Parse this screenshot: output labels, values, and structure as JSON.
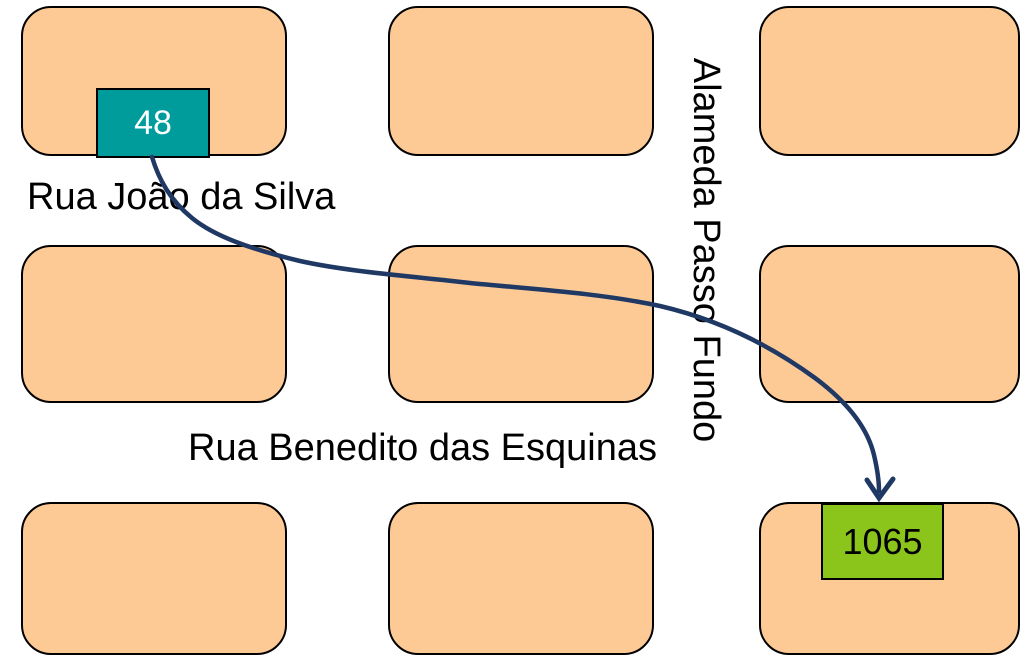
{
  "diagram_title": "street map route diagram",
  "streets": {
    "street_1": "Rua João da Silva",
    "street_2": "Rua Benedito das Esquinas",
    "street_vertical": "Alameda Passo Fundo"
  },
  "route": {
    "from_number": "48",
    "to_number": "1065"
  },
  "colors": {
    "background": "#FFFFFF",
    "block_fill": "#FDCA96",
    "block_border": "#000000",
    "origin_fill": "#009C9C",
    "origin_text": "#FFFFFF",
    "destination_fill": "#8BC41A",
    "destination_text": "#000000",
    "arrow": "#1F3864",
    "street_text": "#000000"
  }
}
